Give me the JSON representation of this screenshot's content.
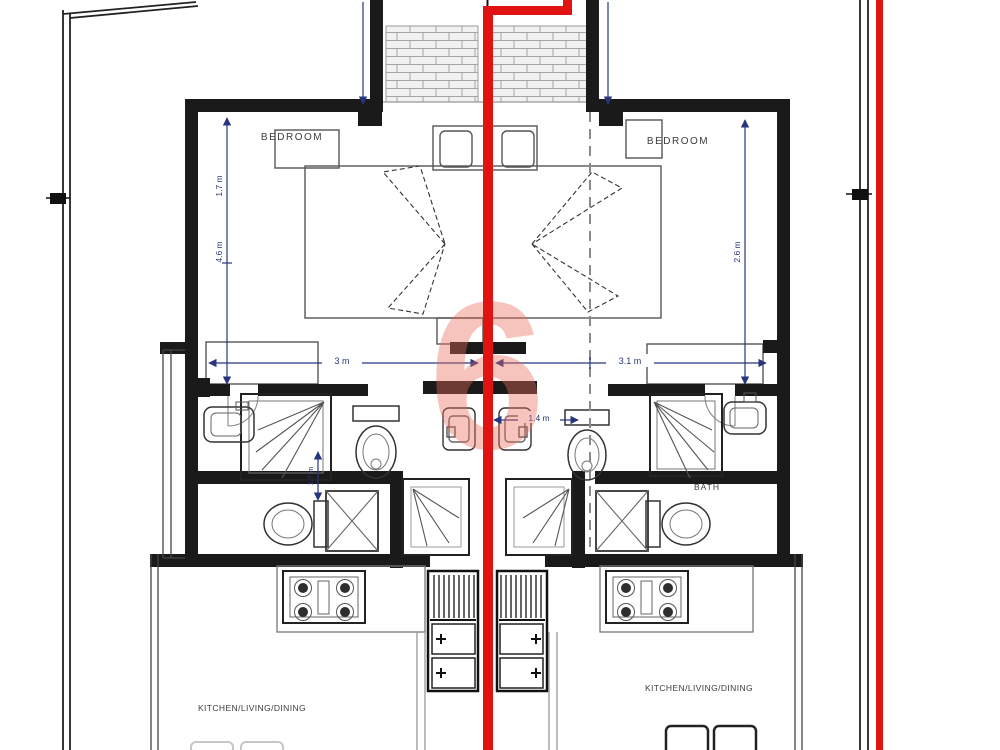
{
  "plan": {
    "watermark_letter": "6",
    "rooms": {
      "bedroom_left": "BEDROOM",
      "bedroom_right": "BEDROOM",
      "bath_right": "BATH",
      "living_left": "KITCHEN/LIVING/DINING",
      "living_right": "KITCHEN/LIVING/DINING"
    },
    "dims": {
      "width_left": "3 m",
      "width_right": "3.1 m",
      "width_center": "1.4 m",
      "depth_left_upper": "1.7 m",
      "depth_left_lower": "4.6 m",
      "depth_right": "2.6 m",
      "bath_left": "1.7 m"
    },
    "colors": {
      "wall": "#1a1a1a",
      "furniture_line": "#555555",
      "dimension_blue": "#27357e",
      "pipe_red": "#e01212",
      "watermark_red": "#e96a5c",
      "dashed_gray": "#8a8a8a",
      "brick_hatch": "#a5a5a5"
    }
  }
}
